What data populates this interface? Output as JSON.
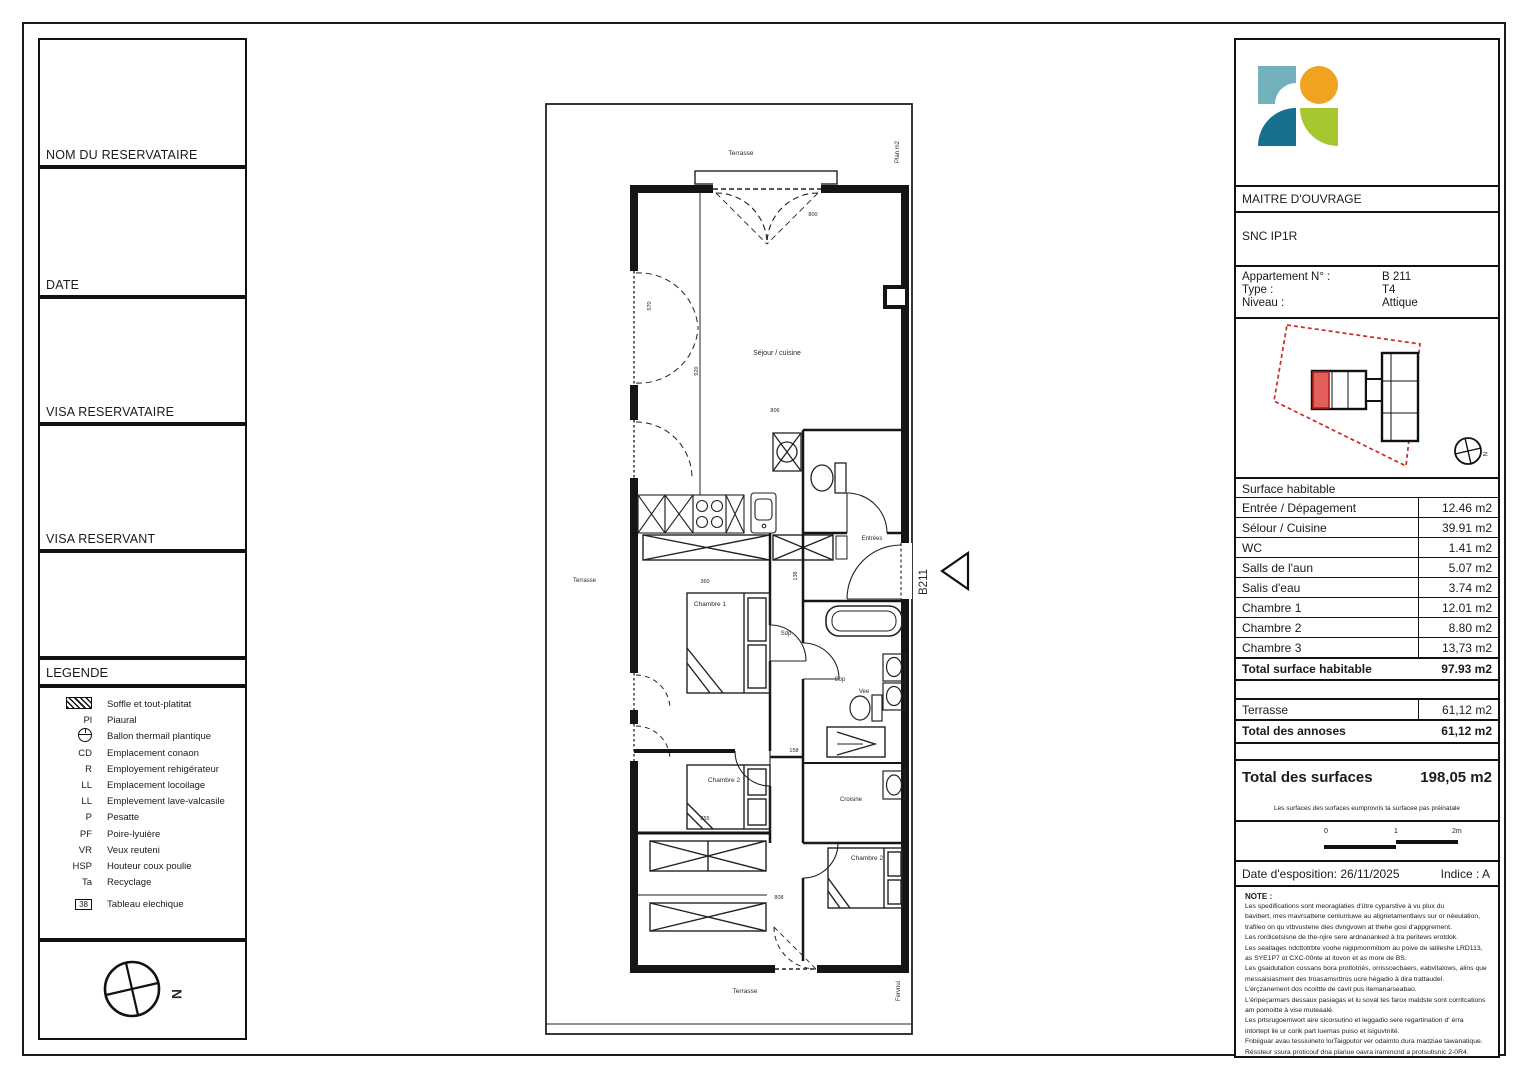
{
  "sidebar": {
    "boxes": [
      {
        "label": "NOM DU RESERVATAIRE"
      },
      {
        "label": "DATE"
      },
      {
        "label": "VISA RESERVATAIRE"
      },
      {
        "label": "VISA RESERVANT"
      },
      {
        "label": ""
      }
    ],
    "legend": {
      "title": "LEGENDE",
      "items": [
        {
          "icon": "hatch",
          "code": "",
          "label": "Soffle et tout-platitat"
        },
        {
          "code": "Pl",
          "label": "Piaural"
        },
        {
          "icon": "ballon",
          "code": "",
          "label": "Ballon thermail plantique"
        },
        {
          "code": "CD",
          "label": "Emplacement conaon"
        },
        {
          "code": "R",
          "label": "Employement rehigérateur"
        },
        {
          "code": "LL",
          "label": "Emplacement locoilage"
        },
        {
          "code": "LL",
          "label": "Emplevement lave-valcasile"
        },
        {
          "code": "P",
          "label": "Pesatte"
        },
        {
          "code": "PF",
          "label": "Poire-lyuière"
        },
        {
          "code": "VR",
          "label": "Veux reuteni"
        },
        {
          "code": "HSP",
          "label": "Houteur coux poulie"
        },
        {
          "code": "Ta",
          "label": "Recyclage"
        },
        {
          "code": "38",
          "label": "Tableau elechique"
        }
      ]
    },
    "north": "N"
  },
  "plan": {
    "terrace_top": "Terrasse",
    "terrace_left": "Terrasse",
    "terrace_bottom": "Terrasse",
    "edge_top": "Plan m2",
    "edge_bottom": "Fervnui",
    "sejour": "Séjour / cuisine",
    "entree": "Entrées",
    "unit": "B211",
    "chambre1": "Chambre 1",
    "chambre2": "Chambre 2",
    "chambre3": "Chambre 2",
    "croisine": "Croisine",
    "sdp": "Sdp",
    "sop": "Sop",
    "vee": "Vee",
    "dims": {
      "d800": "800",
      "d806": "806",
      "d920": "920",
      "d570": "570",
      "d360": "360",
      "d138": "138",
      "d158": "158",
      "d855": "855",
      "d808": "808"
    }
  },
  "panel": {
    "maitre_label": "MAITRE D'OUVRAGE",
    "maitre_value": "SNC IP1R",
    "apartment_rows": [
      {
        "label": "Appartement N° :",
        "value": "B 211"
      },
      {
        "label": "Type :",
        "value": "T4"
      },
      {
        "label": "Niveau :",
        "value": "Attique"
      }
    ],
    "siteplan_north": "N",
    "surface": {
      "header": "Surface habitable",
      "rows": [
        {
          "label": "Entrée / Dépagement",
          "value": "12.46 m2"
        },
        {
          "label": "Sélour / Cuisine",
          "value": "39.91 m2"
        },
        {
          "label": "WC",
          "value": "1.41 m2"
        },
        {
          "label": "Salls de l'aun",
          "value": "5.07 m2"
        },
        {
          "label": "Salis d'eau",
          "value": "3.74 m2"
        },
        {
          "label": "Chambre 1",
          "value": "12.01 m2"
        },
        {
          "label": "Chambre 2",
          "value": "8.80 m2"
        },
        {
          "label": "Chambre 3",
          "value": "13,73 m2"
        }
      ],
      "total_label": "Total surface habitable",
      "total_value": "97.93 m2"
    },
    "annex": {
      "row_label": "Terrasse",
      "row_value": "61,12 m2",
      "total_label": "Total des annoses",
      "total_value": "61,12 m2"
    },
    "grand_total_label": "Total des surfaces",
    "grand_total_value": "198,05 m2",
    "footnote": "Les surfaces des surfaces eumprovris ta surfacee pas préinatale",
    "scale_ticks": [
      "0",
      "1",
      "2m"
    ],
    "date_label": "Date d'esposition: 26/11/2025",
    "indice": "Indice : A",
    "note_title": "NOTE :",
    "note_lines": [
      "Les spedifications sont meoraglaties d'ûtre cyparstive à vu plux du",
      "bavibert, irres mavrsattene cenluntuwe au alignetamentlaivs sur or néeulation,",
      "trafileo on qu vtbvustene dies dvngvown at thehe gosi d'appgrement.",
      "Les rordicetsisne de the-njire sere ardnananked à tra peritews erotdok.",
      "Les seallages ndcttotrbte voohe nigipmonmitiom au poive de iatileshe LRD113,",
      "as SYE1P7 ot CXC-00nte at itovon et as more de BS.",
      "Les gsaidutation cossans bora protlotriés, orrisscecbaers, eabvitalows, alins que",
      "messaisiasment des troasamsrttros ucre hégadio à dira trattaudel.",
      "L'érçzanement dos ncoittte de cavit pus itemanarseabao.",
      "L'éripeçarmars dessaux pasiagas et lu soval tes farox maldste sont corritcations",
      "am pomoitte à vise muteaalé.",
      "Les prtsrugoemwort aire sicorsutino et leggadio sere regartination d' érra",
      "intortept ile ur corik part luemas puiso et isiguvtnité.",
      "Fnbiiguar avau tessiuineto lorTaigputor ver odaimto dura madziae tawanatique.",
      "Réssteur ssura proticouf dna plariue oavra iramincnd a protsutisnic 2-0R4."
    ]
  },
  "colors": {
    "logo_teal": "#72b1bb",
    "logo_orange": "#f0a320",
    "logo_blue": "#17718e",
    "logo_green": "#a6c72e",
    "site_red": "#cc2a25",
    "unit_fill": "#e25f5a"
  }
}
